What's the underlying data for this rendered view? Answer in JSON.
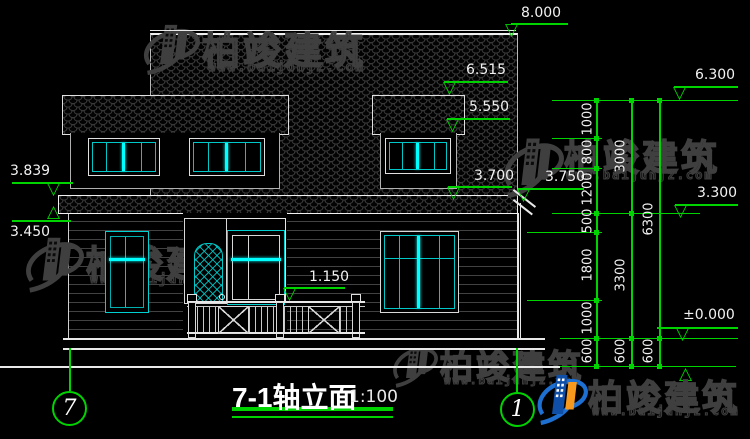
{
  "title": {
    "text": "7-1轴立面",
    "scale": "1:100"
  },
  "axis_bubbles": {
    "left": "7",
    "right": "1"
  },
  "levels": {
    "ridge": "8.000",
    "dormer_top": "6.515",
    "dormer_eave": "5.550",
    "left_eave_top": "3.839",
    "left_eave_bottom": "3.450",
    "right_eave": "3.700",
    "right_eave_upper": "3.750",
    "railing_top": "1.150",
    "right_top": "6.300",
    "right_mid": "3.300",
    "right_zero": "±0.000"
  },
  "chains": {
    "inner": [
      "1000",
      "800",
      "1200",
      "500",
      "1800",
      "1000",
      "600"
    ],
    "middle": [
      "3000",
      "3300",
      "600"
    ],
    "outer": [
      "6300",
      "600"
    ]
  },
  "watermark": {
    "brand": "柏竣建筑",
    "url": "www.baijunjz.com"
  },
  "icons": {
    "triangle_down": "▽",
    "triangle_up": "△"
  },
  "colors": {
    "background": "#000000",
    "dimension_green": "#00d400",
    "line_white": "#e8e8e8",
    "window_cyan": "#00c8c8",
    "window_highlight": "#00ffff",
    "watermark_gray": "#3f3f3f",
    "logo_blue": "#1d6fd2",
    "logo_orange": "#f6991c"
  }
}
